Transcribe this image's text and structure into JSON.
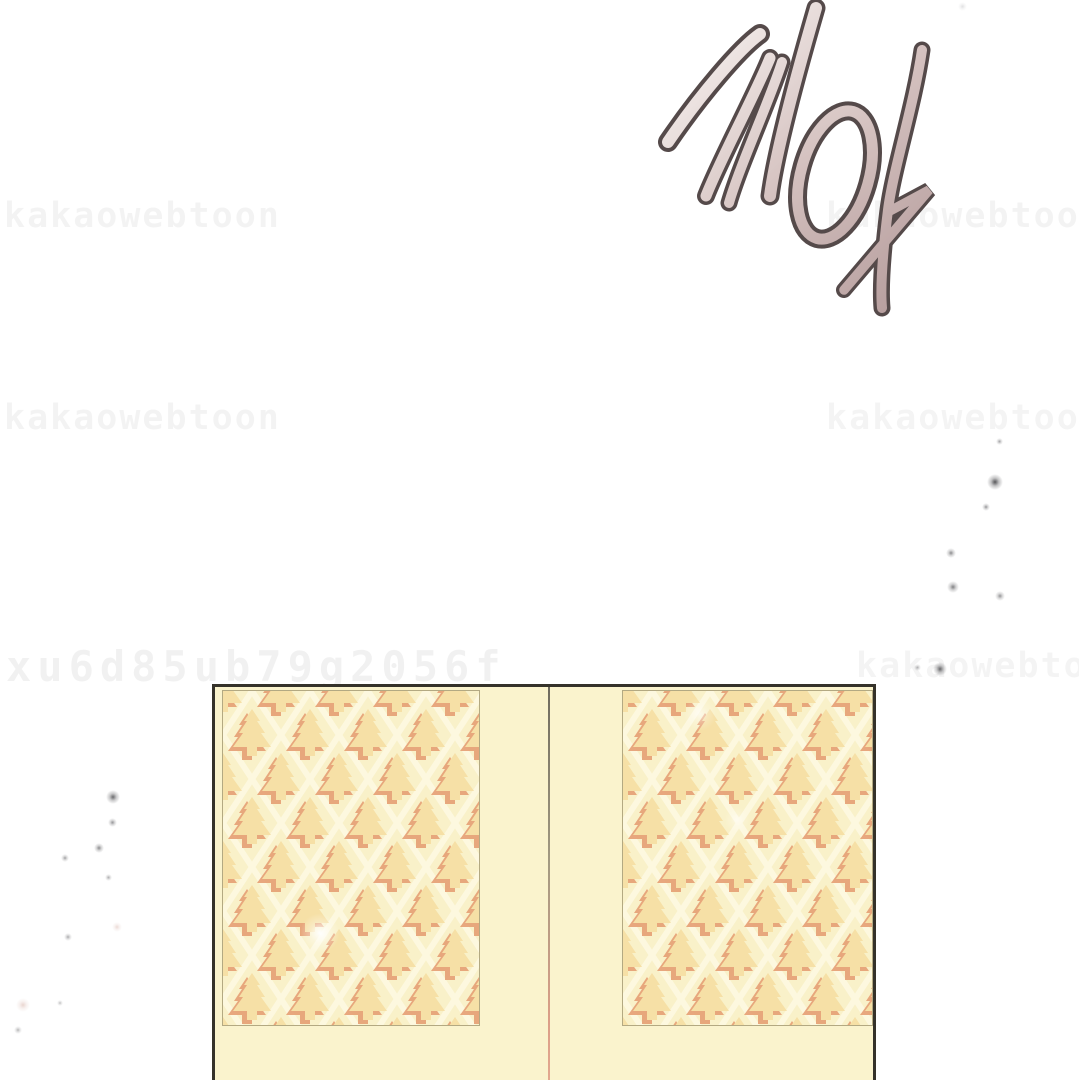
{
  "panel": {
    "background_color": "#ffffff",
    "sfx": {
      "text": "끼익",
      "outline_color": "#554a4a",
      "fill_gradient_start": "#f7f2f0",
      "fill_gradient_end": "#b49b9b"
    },
    "watermarks": {
      "brand": "kakaowebtoon",
      "id_code": "xu6d85ub79g2056f",
      "instances": [
        {
          "text": "kakaowebtoon",
          "x": 4,
          "y": 196,
          "size": 35,
          "spacing": 2,
          "opacity": 0.045
        },
        {
          "text": "kakaowebtoon",
          "x": 826,
          "y": 196,
          "size": 35,
          "spacing": 2,
          "opacity": 0.045
        },
        {
          "text": "kakaowebtoon",
          "x": 4,
          "y": 398,
          "size": 35,
          "spacing": 2,
          "opacity": 0.045
        },
        {
          "text": "kakaowebtoon",
          "x": 826,
          "y": 398,
          "size": 35,
          "spacing": 2,
          "opacity": 0.04
        },
        {
          "text": "xu6d85ub79g2056f",
          "x": 6,
          "y": 642,
          "size": 42,
          "spacing": 6,
          "opacity": 0.05
        },
        {
          "text": "kakaowebtoon",
          "x": 856,
          "y": 646,
          "size": 35,
          "spacing": 2,
          "opacity": 0.04
        }
      ]
    },
    "door": {
      "frame_color": "#35322a",
      "body_color": "#faf3cd",
      "divider_top_color": "#6f6b5e",
      "divider_bottom_color": "#db9e87",
      "panel_background": "#f9f1c9",
      "lattice_color": "#fdf8df",
      "motif_color": "#f6e0a6",
      "motif_shadow_color": "#e69f74",
      "panel_border_color": "#8f845f"
    },
    "sparkles": [
      {
        "x": 995,
        "y": 482,
        "size": 16,
        "opacity": 0.8,
        "color": "#2a2a2e"
      },
      {
        "x": 986,
        "y": 507,
        "size": 8,
        "opacity": 0.5,
        "color": "#2a2a2e"
      },
      {
        "x": 951,
        "y": 553,
        "size": 10,
        "opacity": 0.55,
        "color": "#2a2a2e"
      },
      {
        "x": 953,
        "y": 587,
        "size": 12,
        "opacity": 0.6,
        "color": "#2a2a2e"
      },
      {
        "x": 1000,
        "y": 596,
        "size": 10,
        "opacity": 0.5,
        "color": "#2a2a2e"
      },
      {
        "x": 940,
        "y": 669,
        "size": 14,
        "opacity": 0.7,
        "color": "#2a2a2e"
      },
      {
        "x": 917,
        "y": 667,
        "size": 7,
        "opacity": 0.4,
        "color": "#2a2a2e"
      },
      {
        "x": 999,
        "y": 441,
        "size": 7,
        "opacity": 0.45,
        "color": "#2a2a2e"
      },
      {
        "x": 962,
        "y": 6,
        "size": 9,
        "opacity": 0.3,
        "color": "#9a9aa0"
      },
      {
        "x": 113,
        "y": 797,
        "size": 14,
        "opacity": 0.7,
        "color": "#2a2a2e"
      },
      {
        "x": 112,
        "y": 822,
        "size": 9,
        "opacity": 0.5,
        "color": "#2a2a2e"
      },
      {
        "x": 99,
        "y": 848,
        "size": 10,
        "opacity": 0.55,
        "color": "#2a2a2e"
      },
      {
        "x": 65,
        "y": 858,
        "size": 8,
        "opacity": 0.45,
        "color": "#2a2a2e"
      },
      {
        "x": 108,
        "y": 877,
        "size": 7,
        "opacity": 0.4,
        "color": "#2a2a2e"
      },
      {
        "x": 117,
        "y": 927,
        "size": 10,
        "opacity": 0.3,
        "color": "#c08878"
      },
      {
        "x": 68,
        "y": 937,
        "size": 8,
        "opacity": 0.4,
        "color": "#2a2a2e"
      },
      {
        "x": 23,
        "y": 1005,
        "size": 14,
        "opacity": 0.35,
        "color": "#c08878"
      },
      {
        "x": 18,
        "y": 1030,
        "size": 8,
        "opacity": 0.35,
        "color": "#2a2a2e"
      },
      {
        "x": 60,
        "y": 1003,
        "size": 6,
        "opacity": 0.3,
        "color": "#2a2a2e"
      },
      {
        "x": 320,
        "y": 933,
        "size": 40,
        "opacity": 0.95,
        "color": "#ffffff"
      },
      {
        "x": 700,
        "y": 714,
        "size": 34,
        "opacity": 0.6,
        "color": "#ffffff"
      },
      {
        "x": 737,
        "y": 820,
        "size": 26,
        "opacity": 0.5,
        "color": "#ffffff"
      }
    ]
  }
}
